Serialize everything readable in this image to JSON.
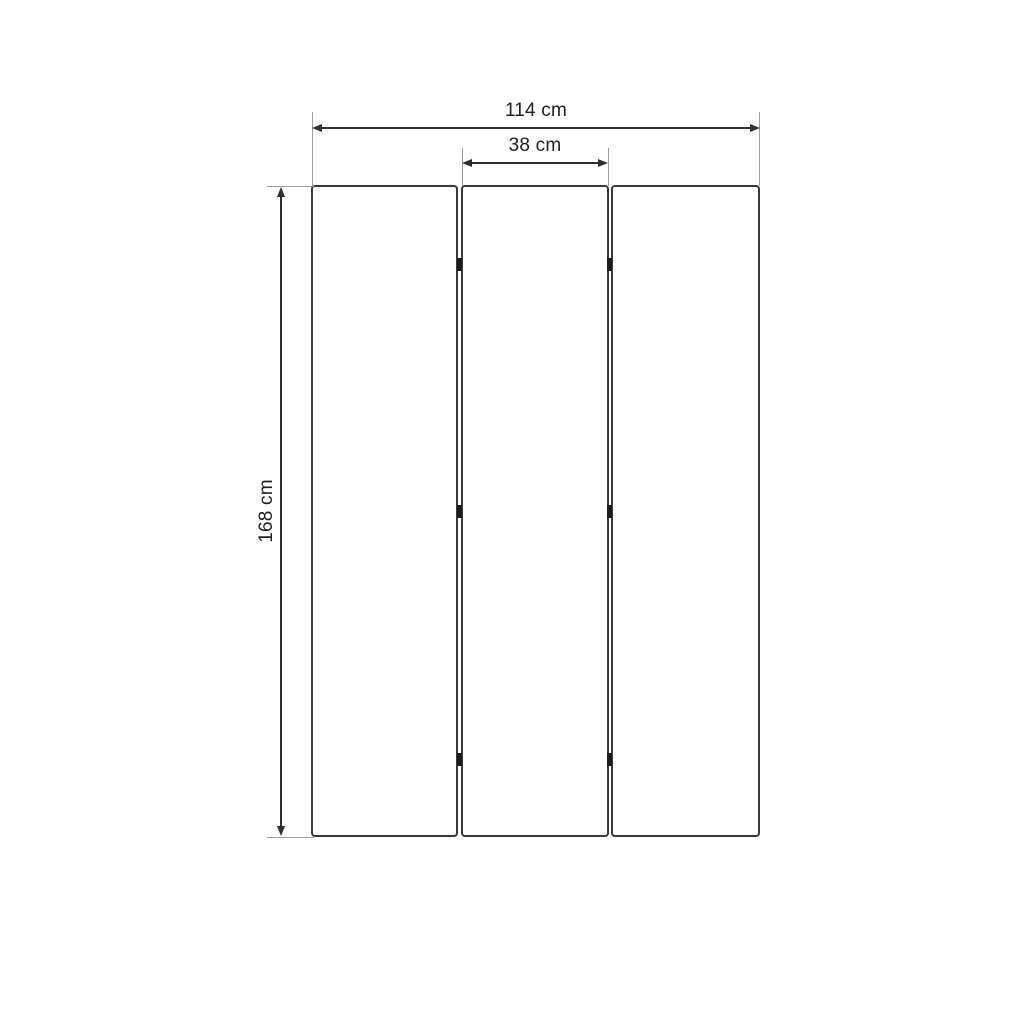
{
  "diagram": {
    "title": "Three-panel folding screen dimension drawing",
    "panel_count": 3,
    "dimensions": {
      "total_width": {
        "label": "114 cm"
      },
      "panel_width": {
        "label": "38 cm"
      },
      "height": {
        "label": "168 cm"
      }
    },
    "colors": {
      "outline": "#3a3a3a",
      "dimension_line": "#2e2e2e",
      "extension_line": "#9c9c9c",
      "hinge": "#1c1c1c",
      "text": "#1e1e1e",
      "background": "#ffffff"
    }
  }
}
